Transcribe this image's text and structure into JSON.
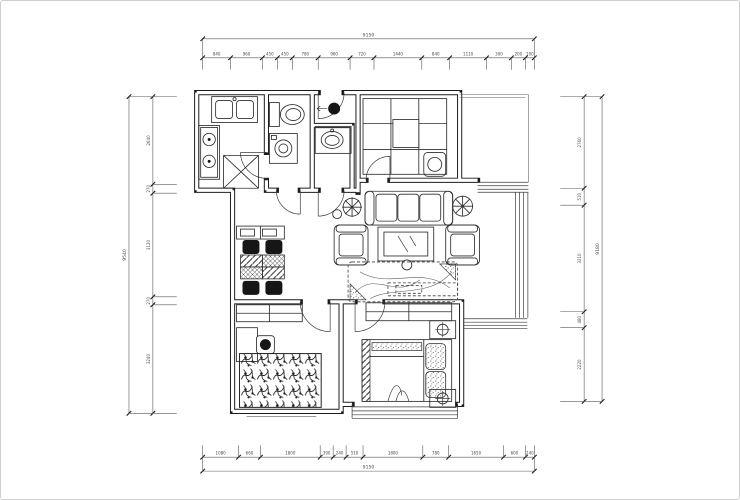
{
  "colors": {
    "background": "#ffffff",
    "plan_line": "#2e2e2e",
    "wall": "#1c1c1c",
    "dimension_line": "#5a5a5a",
    "canvas_border": "#cfcfcf"
  },
  "dimensions": {
    "top": {
      "total": "9150",
      "segments": [
        "840",
        "960",
        "450",
        "450",
        "780",
        "960",
        "720",
        "1440",
        "840",
        "1110",
        "300",
        "200",
        "100"
      ]
    },
    "bottom": {
      "total": "9150",
      "segments": [
        "1080",
        "660",
        "1800",
        "390",
        "240",
        "510",
        "1800",
        "780",
        "1650",
        "600",
        "240"
      ]
    },
    "left": {
      "total": "9540",
      "segments": [
        "2640",
        "270",
        "3120",
        "270",
        "3240"
      ]
    },
    "right": {
      "total": "9180",
      "segments": [
        "2760",
        "510",
        "3210",
        "480",
        "2220"
      ]
    }
  }
}
